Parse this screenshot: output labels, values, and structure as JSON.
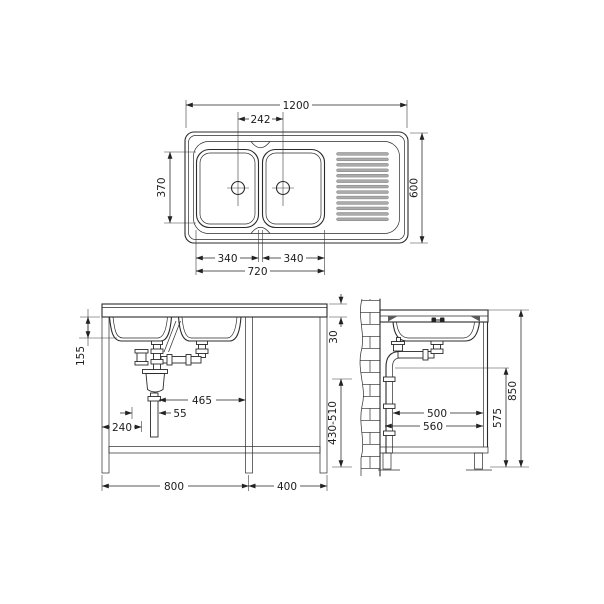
{
  "labels": {
    "plan": {
      "width": "1200",
      "tap_spacing": "242",
      "bowl_depth": "370",
      "depth": "600",
      "bowl_left_width": "340",
      "bowl_right_width": "340",
      "bowls_width": "720"
    },
    "front": {
      "bowl_height": "155",
      "rim_height": "30",
      "drain_offset": "465",
      "trap_offset": "55",
      "trap_wall_distance": "240",
      "cabinet_width": "800",
      "side_unit_width": "400",
      "outlet_height_range": "430-510"
    },
    "side": {
      "pipe_distance": "500",
      "depth": "560",
      "outlet_height": "575",
      "worktop_height": "850"
    }
  }
}
